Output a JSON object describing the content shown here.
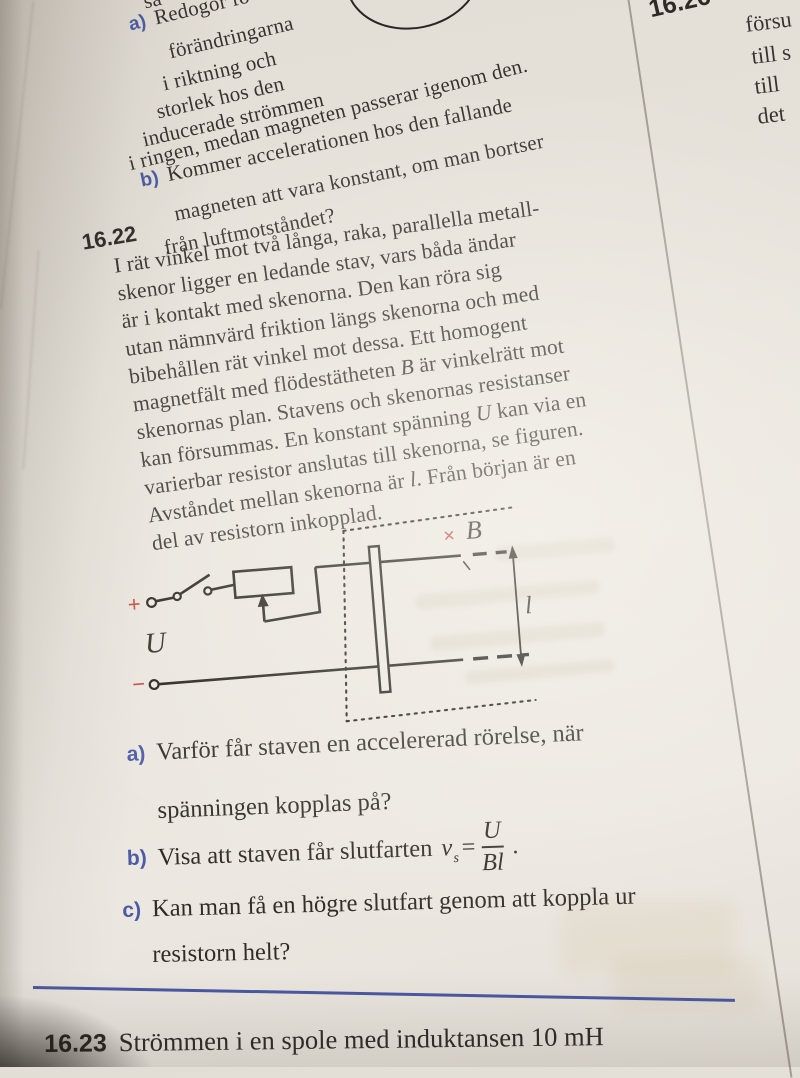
{
  "colors": {
    "accent_blue": "#4b5ba6",
    "accent_red": "#c7433a",
    "divider_blue": "#4a57a3",
    "ink": "#332f29",
    "paper": "#e8e4dc"
  },
  "prev_problem": {
    "fragment_top": "så",
    "a_label": "a)",
    "a_lines": [
      "Redogör fö",
      "förändringarna",
      "i riktning och",
      "storlek hos den",
      "inducerade strömmen",
      "i ringen, medan magneten passerar igenom den."
    ],
    "b_label": "b)",
    "b_lines": [
      "Kommer accelerationen hos den fallande",
      "magneten att vara konstant, om man bortser",
      "från luftmotståndet?"
    ]
  },
  "problem_16_22": {
    "number": "16.22",
    "body_lines": [
      [
        [
          "I rät vinkel mot två långa, raka, parallella metall-"
        ]
      ],
      [
        [
          "skenor ligger en ledande stav, vars båda ändar"
        ]
      ],
      [
        [
          "är i kontakt med skenorna. Den kan röra sig"
        ]
      ],
      [
        [
          "utan nämnvärd friktion längs skenorna och med"
        ]
      ],
      [
        [
          "bibehållen rät vinkel mot dessa. Ett homogent"
        ]
      ],
      [
        [
          "magnetfält med flödestätheten "
        ],
        [
          "B",
          1
        ],
        [
          " är vinkelrätt mot"
        ]
      ],
      [
        [
          "skenornas plan. Stavens och skenornas resistanser"
        ]
      ],
      [
        [
          "kan försummas. En konstant spänning "
        ],
        [
          "U",
          1
        ],
        [
          " kan via en"
        ]
      ],
      [
        [
          "varierbar resistor anslutas till skenorna, se figuren."
        ]
      ],
      [
        [
          "Avståndet mellan skenorna är "
        ],
        [
          "l",
          1
        ],
        [
          ". Från början är en"
        ]
      ],
      [
        [
          "del av resistorn inkopplad."
        ]
      ]
    ],
    "diagram": {
      "plus": "+",
      "minus": "−",
      "voltage_label": "U",
      "cross": "×",
      "field_label": "B",
      "length_label": "l"
    },
    "questions": {
      "a_label": "a)",
      "a_line1": "Varför får staven en accelererad rörelse, när",
      "a_line2": "spänningen kopplas på?",
      "b_label": "b)",
      "b_text": "Visa att staven får slutfarten",
      "b_var": "v",
      "b_var_sub": "s",
      "b_equals": "=",
      "b_numerator": "U",
      "b_denominator": "Bl",
      "b_period": ".",
      "c_label": "c)",
      "c_line1": "Kan man få en högre slutfart genom att koppla ur",
      "c_line2": "resistorn helt?"
    }
  },
  "problem_16_23": {
    "number": "16.23",
    "text": "Strömmen i en spole med induktansen 10 mH"
  },
  "adjacent_column": {
    "number": "16.26",
    "fragments": [
      "försu",
      "till s",
      "till",
      "det"
    ]
  }
}
